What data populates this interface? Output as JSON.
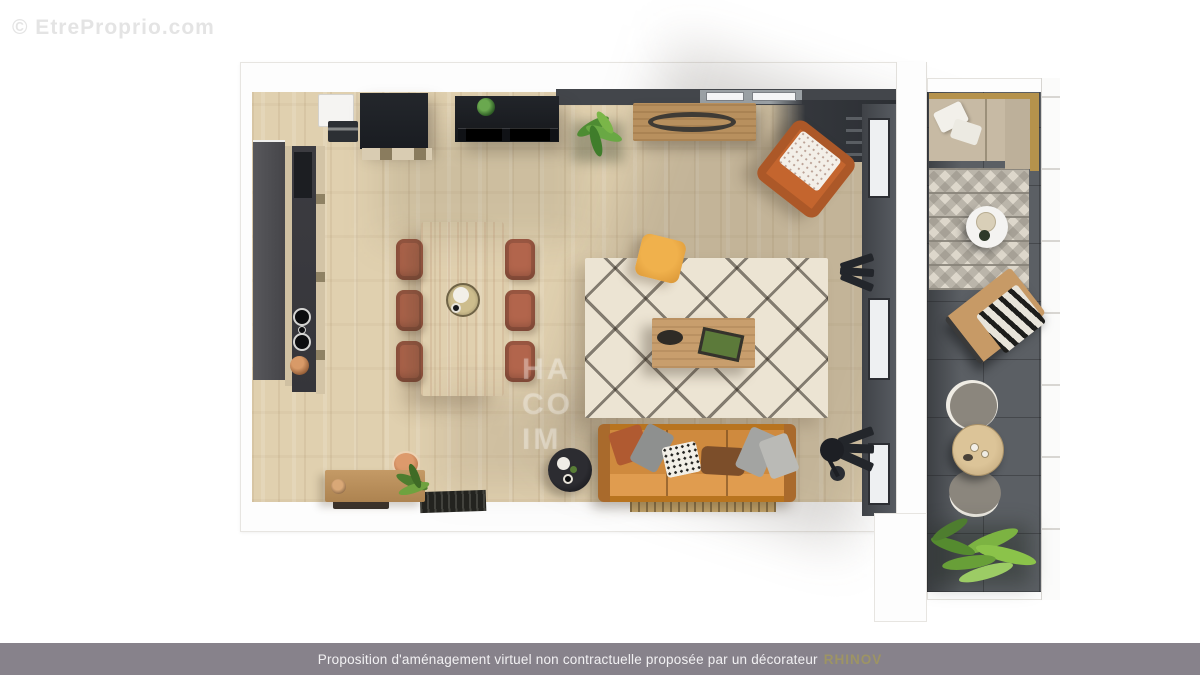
{
  "watermarks": {
    "site": "© EtreProprio.com",
    "agency_lines": [
      "HA",
      "CO",
      "IM"
    ]
  },
  "footer": {
    "disclaimer": "Proposition d'aménagement virtuel non contractuelle proposée par un décorateur",
    "brand": "RHINOV"
  },
  "scene": {
    "type": "3d-floorplan-top-view",
    "rooms": [
      {
        "name": "living-dining-kitchen",
        "floor": "light-oak-planks"
      },
      {
        "name": "balcony-terrace",
        "floor": "dark-grey-tiles"
      }
    ],
    "furniture": [
      "fridge",
      "black-kitchen-cabinet",
      "black-wall-cabinet-with-plant",
      "kitchen-counter-with-sink-and-cooktop",
      "dining-table",
      "dining-chairs-x6",
      "centerpiece-tray",
      "berber-diamond-rug",
      "wood-coffee-table",
      "yellow-pouf",
      "orange-leather-sofa",
      "throw-cushions-x6",
      "black-round-side-table",
      "black-floor-lamp",
      "wood-bench",
      "terracotta-pot-plant",
      "dark-doormat",
      "slatted-shoe-grate",
      "wood-sideboard-oval-inlay",
      "green-plant",
      "orange-armchair-white-cushion",
      "corner-shelf-desk",
      "balcony-l-bench-gold-frame",
      "white-outdoor-pillows",
      "outdoor-patterned-rug",
      "white-round-side-table",
      "wood-lounge-chair-bw-cushion",
      "grey-bistro-chairs-x2",
      "round-wood-bistro-table",
      "fern-plants"
    ]
  },
  "colors": {
    "background": "#ffffff",
    "footer_bar": "#87828b",
    "footer_brand": "#9d9464",
    "floor_wood": "#e0d0af",
    "sofa_orange": "#c47c31",
    "rug_cream": "#ece4d3",
    "balcony_tile": "#5b5f64",
    "kitchen_black": "#1e2126",
    "chair_terracotta": "#b2654c"
  }
}
